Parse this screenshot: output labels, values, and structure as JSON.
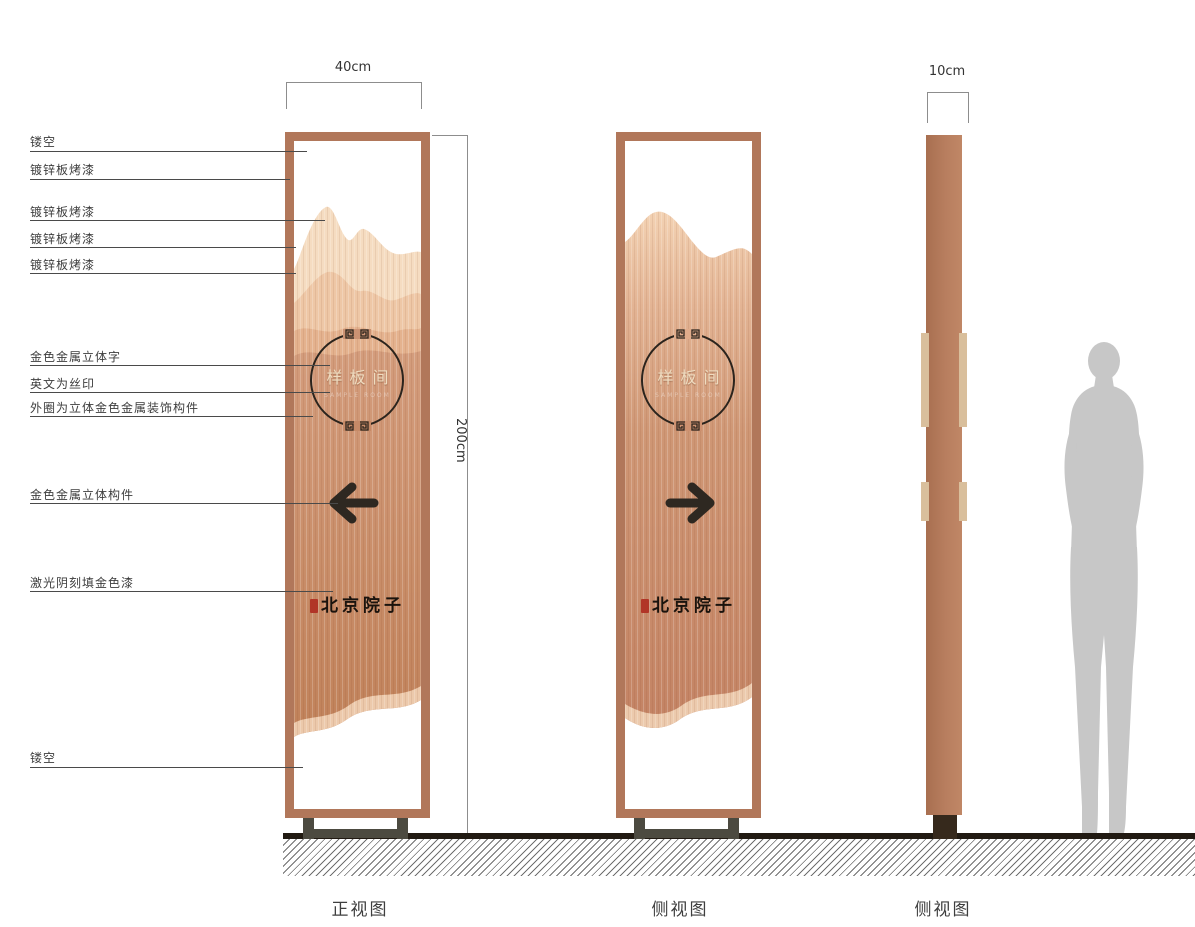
{
  "callouts": [
    "镂空",
    "镀锌板烤漆",
    "镀锌板烤漆",
    "镀锌板烤漆",
    "镀锌板烤漆",
    "金色金属立体字",
    "英文为丝印",
    "外圈为立体金色金属装饰构件",
    "金色金属立体构件",
    "激光阴刻填金色漆",
    "镂空"
  ],
  "dimensions": {
    "width": "40cm",
    "height": "200cm",
    "depth": "10cm"
  },
  "signs": {
    "front": {
      "plaque_title": "样板间",
      "plaque_subtitle": "SAMPLE ROOM",
      "brand": "北京院子",
      "arrow_direction": "left"
    },
    "side": {
      "plaque_title": "样板间",
      "plaque_subtitle": "SAMPLE ROOM",
      "brand": "北京院子",
      "arrow_direction": "right"
    }
  },
  "captions": {
    "front_view": "正视图",
    "side_view_1": "侧视图",
    "side_view_2": "侧视图"
  },
  "colors": {
    "frame_copper": "#b1775a",
    "panel_copper": "#c98f6e",
    "mountain_light": "#f5dcc1",
    "mountain_mid": "#eec7a6",
    "arrow_dark": "#2e2821",
    "brand_ink": "#1a130d",
    "seal_red": "#b13527",
    "metal_gold_text": "#efdcc0",
    "base_dark": "#4c4a40",
    "ground_black": "#211a12",
    "silhouette_gray": "#c7c7c7"
  }
}
